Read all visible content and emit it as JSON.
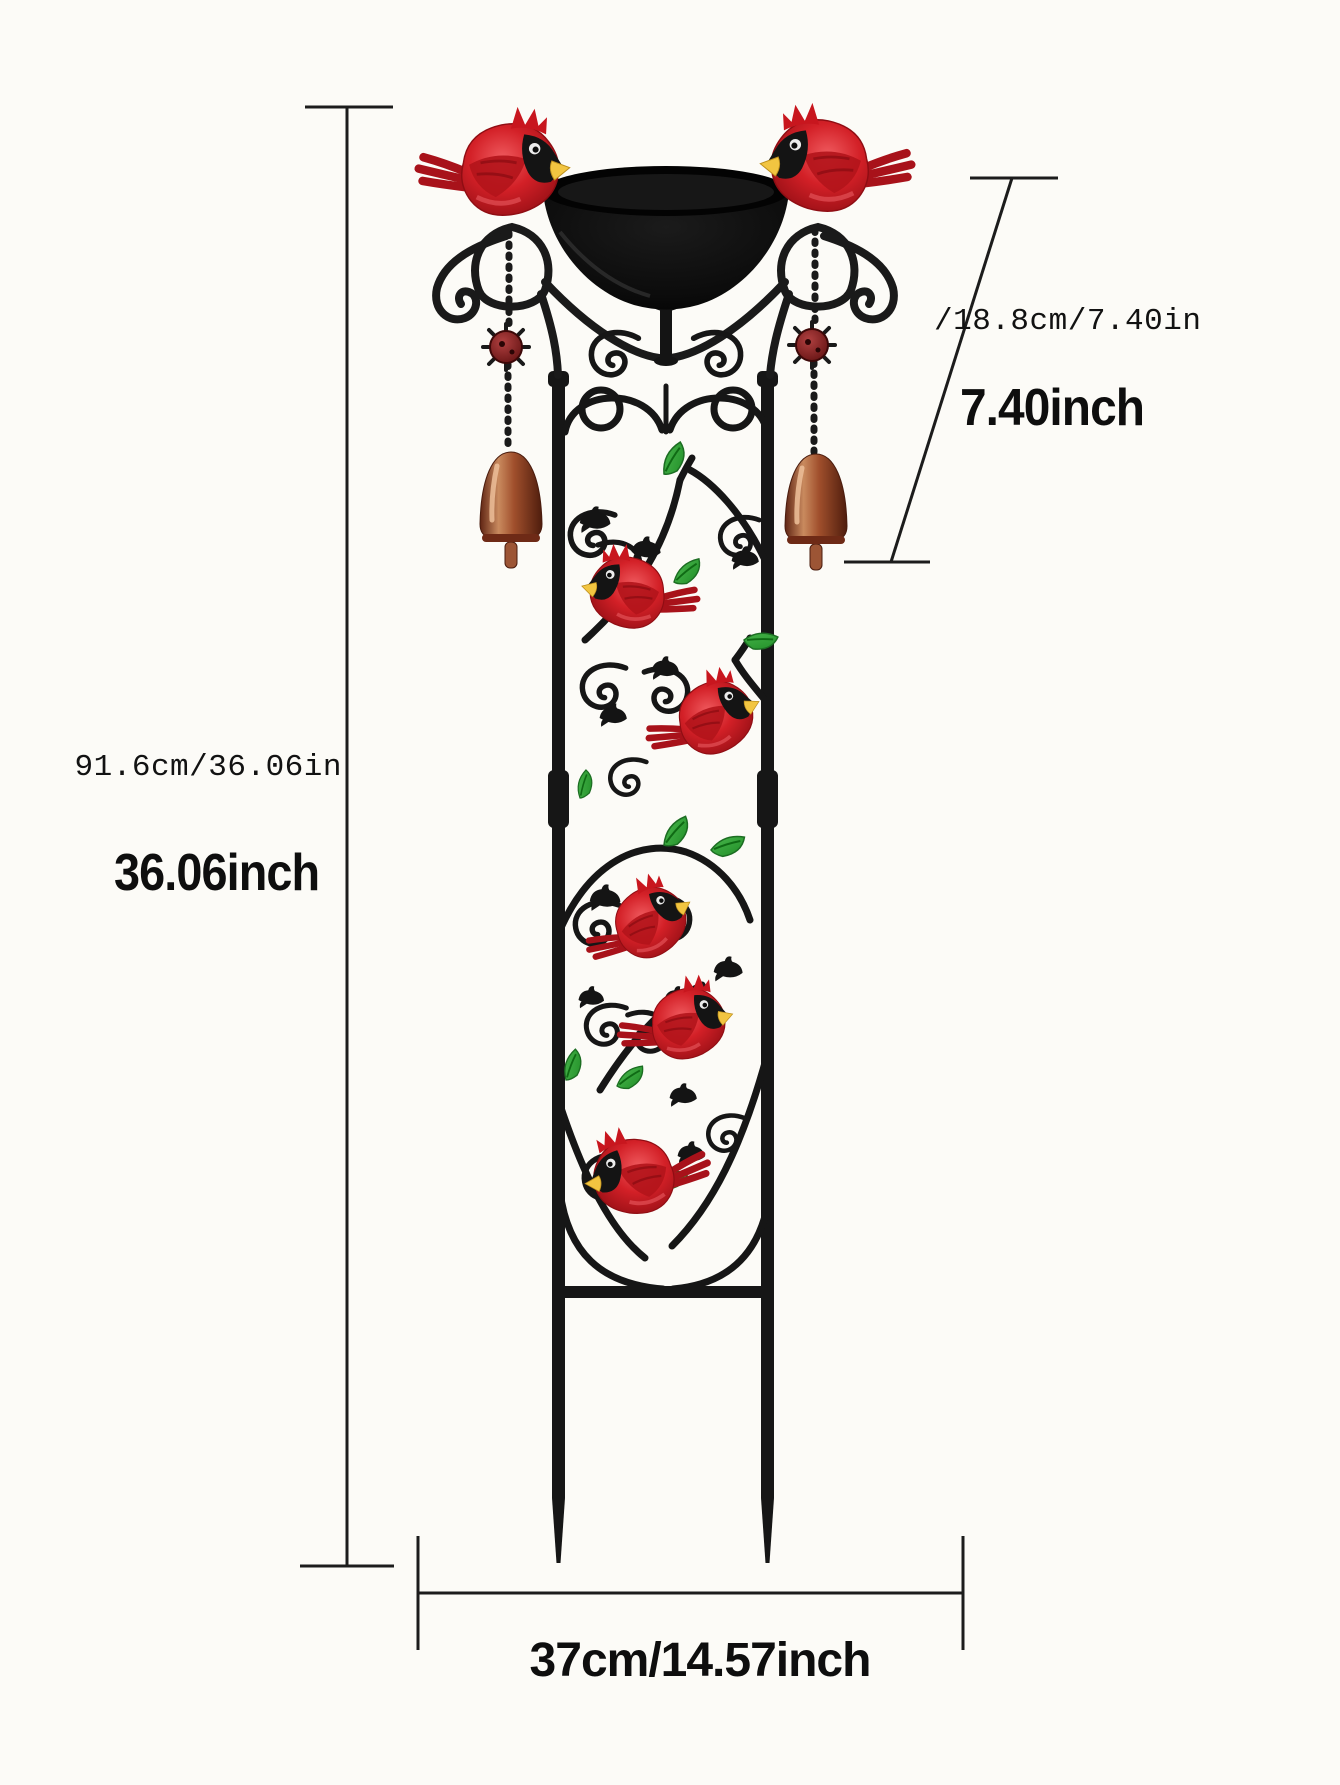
{
  "dimensions": {
    "total_height": {
      "combined": "91.6cm/36.06in",
      "inches": "36.06inch"
    },
    "top_section_height": {
      "combined": "/18.8cm/7.40in",
      "inches": "7.40inch"
    },
    "width": {
      "combined": "37cm/14.57inch"
    }
  },
  "colors": {
    "background": "#fcfbf7",
    "metal_black": "#161616",
    "cardinal_red": "#cf1f26",
    "cardinal_dark_red": "#9a1118",
    "beak_yellow": "#f2c541",
    "leaf_green": "#2f9e33",
    "bell_copper": "#b06a45",
    "bowl_black": "#0b0b0b",
    "dimension_line": "#1c1c1c",
    "text": "#111111"
  }
}
